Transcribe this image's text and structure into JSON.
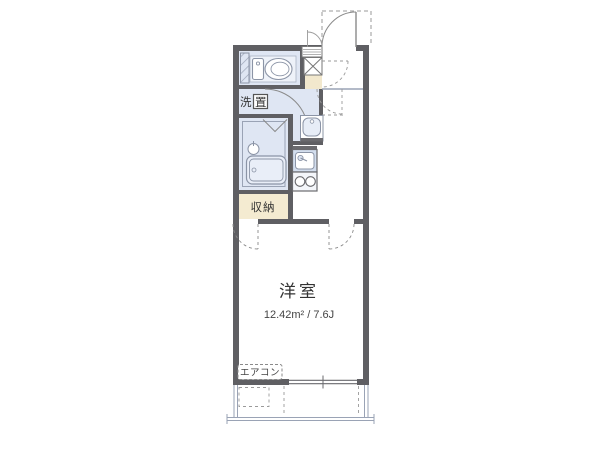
{
  "document": {
    "type": "apartment-floor-plan",
    "canvas": {
      "width": 600,
      "height": 450
    }
  },
  "plan": {
    "labels": {
      "room_name": "洋室",
      "room_size": "12.42m² / 7.6J",
      "closet": "収納",
      "laundry_char1": "洗",
      "laundry_char2": "置",
      "aircon": "エアコン"
    },
    "rooms": [
      {
        "name": "western-room",
        "label": "洋室",
        "size_m2": "12.42",
        "size_jou": "7.6"
      },
      {
        "name": "closet",
        "label": "収納"
      },
      {
        "name": "toilet-room"
      },
      {
        "name": "bathroom"
      },
      {
        "name": "washroom-laundry",
        "label": "洗置"
      },
      {
        "name": "kitchen-corridor"
      },
      {
        "name": "entrance"
      },
      {
        "name": "balcony"
      }
    ],
    "fixtures": [
      "toilet-icon",
      "bathtub-icon",
      "shower-basin-icon",
      "vanity-basin-icon",
      "kitchen-sink-icon",
      "stove-2-burner-icon",
      "shoe-cabinet-icon",
      "meter-box-icon",
      "entrance-door-arc",
      "room-door-arcs",
      "window",
      "aircon-unit"
    ],
    "colors": {
      "wall": "#5f5f63",
      "wet_area_floor": "#dfe6f3",
      "closet_fill": "#f4ebd1",
      "entry_step_fill": "#f2e8cd",
      "fixture_line": "#8b94a6",
      "fixture_fill": "#d3deee",
      "dash_line": "#8a8a8a"
    }
  }
}
